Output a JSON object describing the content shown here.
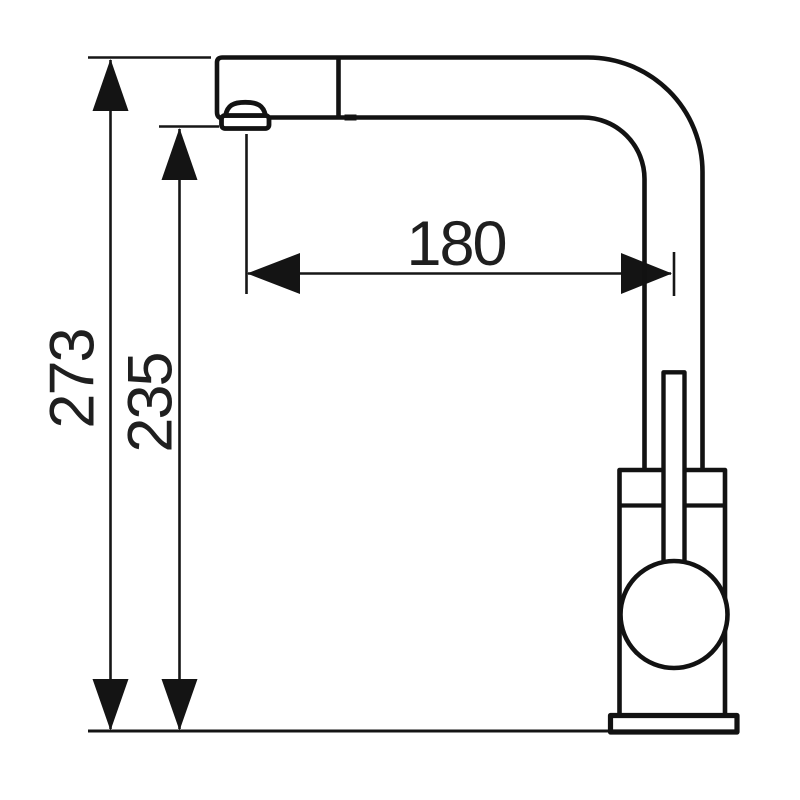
{
  "drawing": {
    "background_color": "#ffffff",
    "line_color": "#141414",
    "dimension_labels": {
      "overall_height": "273",
      "outlet_height": "235",
      "spout_reach": "180"
    }
  }
}
